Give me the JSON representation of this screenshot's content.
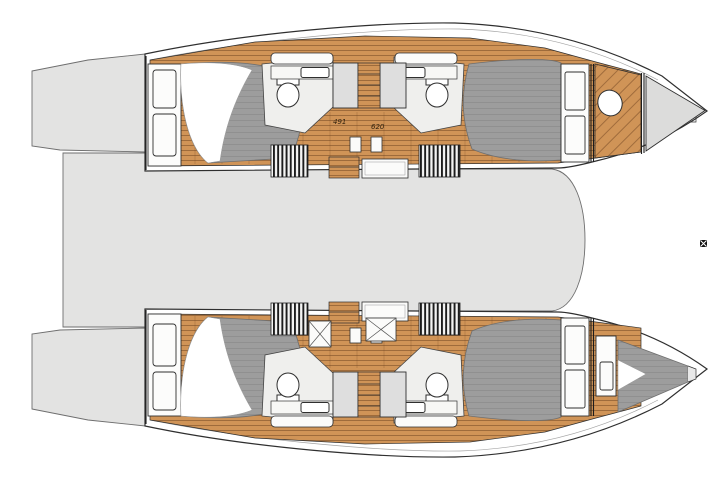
{
  "diagram": {
    "name": "catamaran-deck-plan",
    "dimension_labels": {
      "left": "491",
      "right": "620"
    }
  },
  "colors": {
    "wood": "#d09457",
    "wood-line": "#6f431f",
    "deck-gray": "#e3e3e2",
    "mattress-gray": "#9d9d9d",
    "forepeak-gray": "#dcdcdb",
    "outline": "#2f2f2f"
  }
}
